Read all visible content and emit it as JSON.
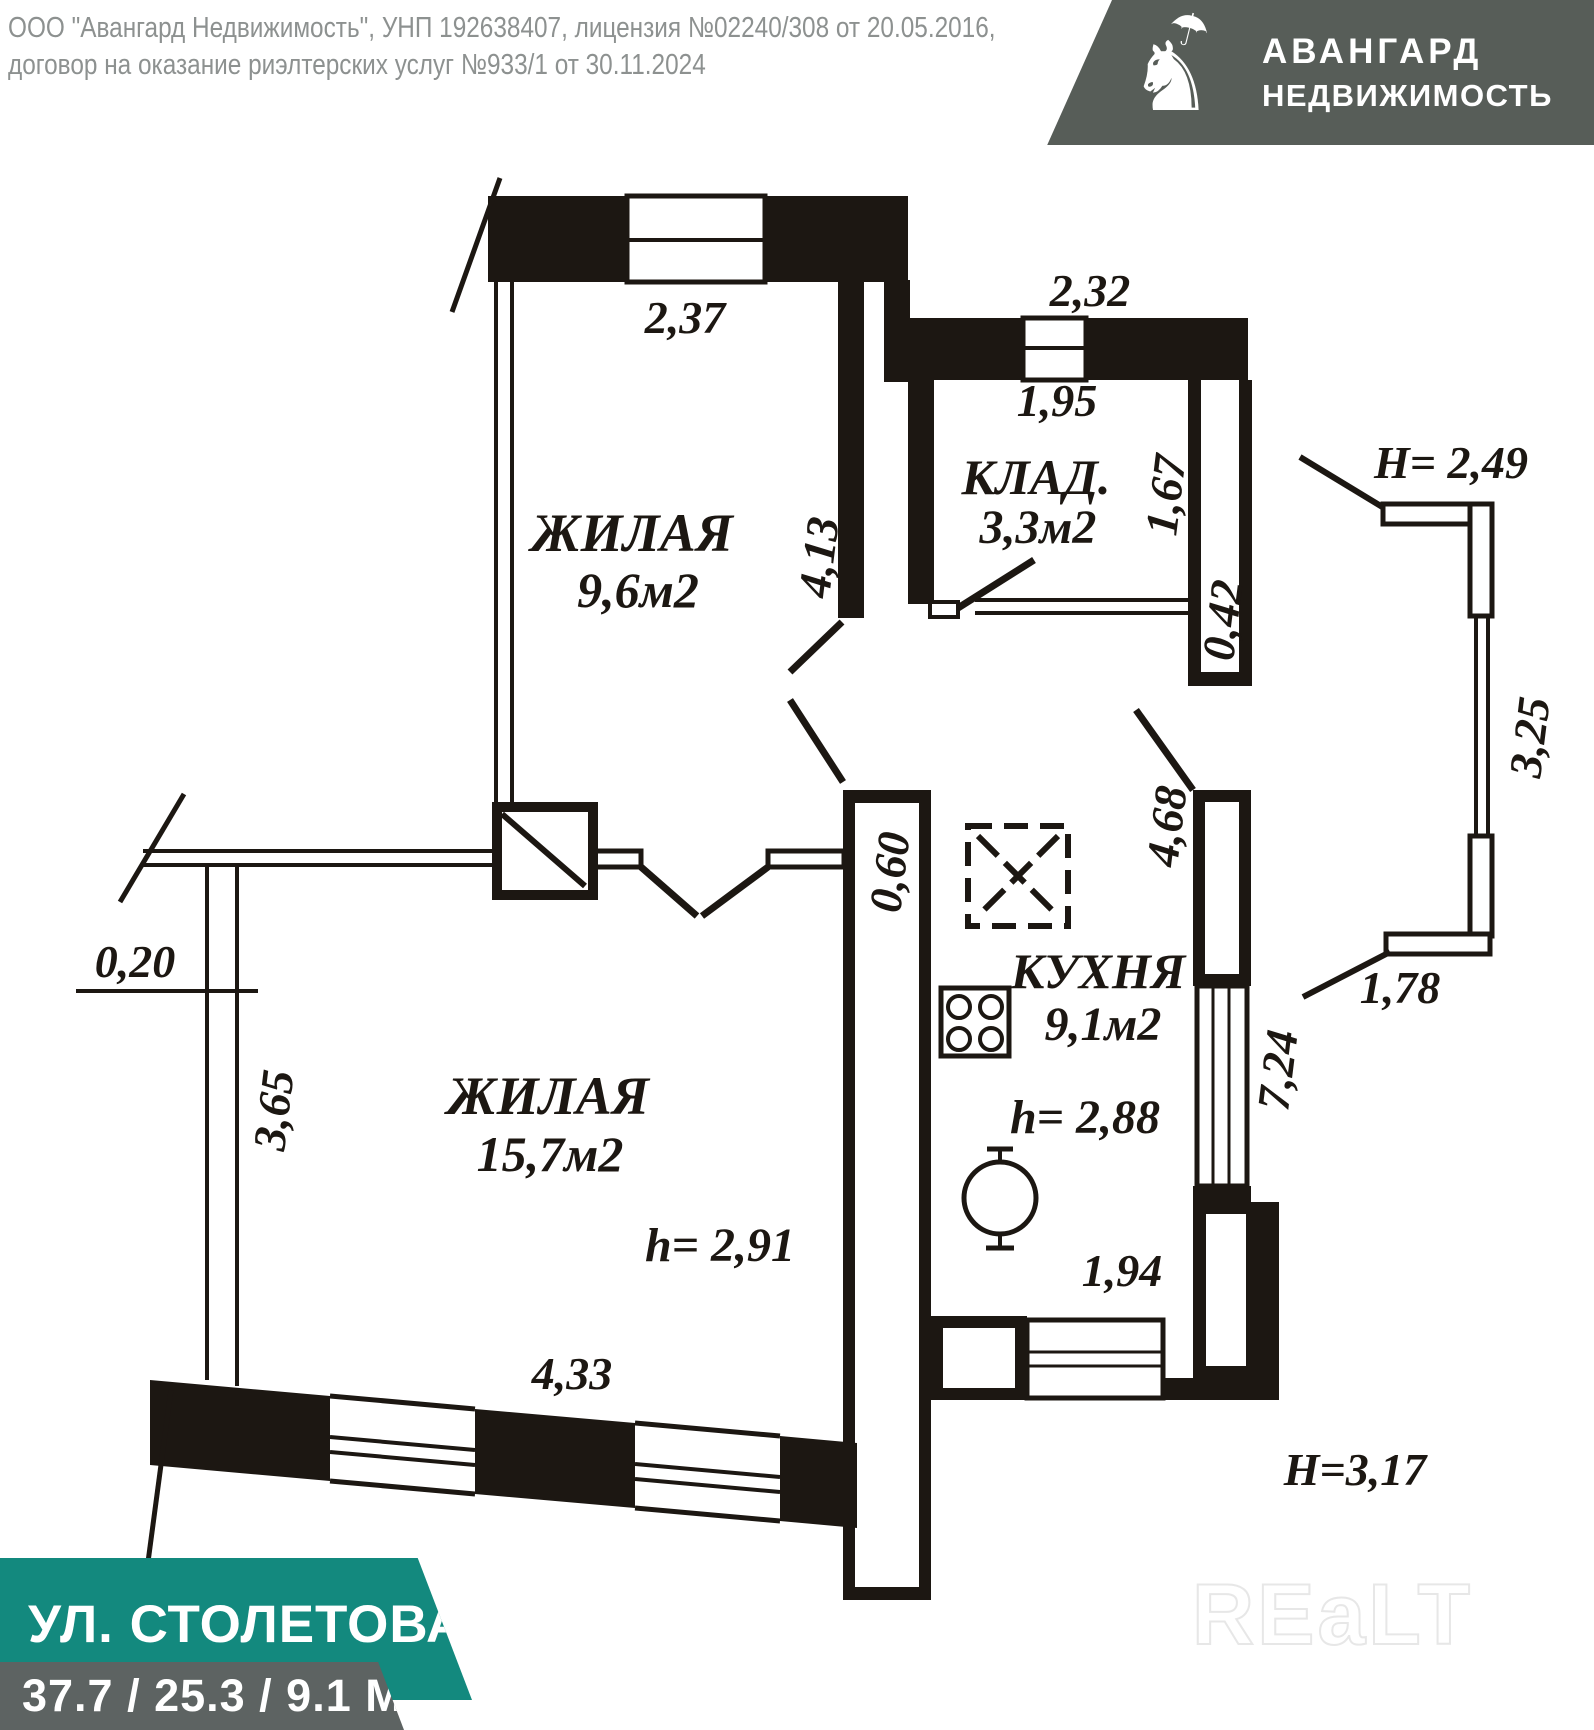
{
  "header": {
    "line1": "ООО \"Авангард Недвижимость\", УНП 192638407, лицензия №02240/308 от 20.05.2016,",
    "line2": "договор на оказание риэлтерских услуг №933/1 от 30.11.2024"
  },
  "logo": {
    "line1": "АВАНГАРД",
    "line2": "НЕДВИЖИМОСТЬ",
    "bg_color": "#575d58",
    "knight_icon": "knight-on-horse-with-umbrella",
    "horse_glyph": "♞",
    "umbrella_glyph": "☂"
  },
  "plan": {
    "ink_color": "#1c1712",
    "room_living1": {
      "name": "ЖИЛАЯ",
      "area": "9,6м2"
    },
    "room_storage": {
      "name": "КЛАД.",
      "area": "3,3м2"
    },
    "room_living2": {
      "name": "ЖИЛАЯ",
      "area": "15,7м2",
      "ceiling": "h= 2,91"
    },
    "room_kitchen": {
      "name": "КУХНЯ",
      "area": "9,1м2",
      "ceiling": "h= 2,88"
    },
    "dims": {
      "d237": "2,37",
      "d232": "2,32",
      "d195": "1,95",
      "d167": "1,67",
      "d042": "0,42",
      "h249": "H= 2,49",
      "d325": "3,25",
      "d178": "1,78",
      "d413": "4,13",
      "d060": "0,60",
      "d468": "4,68",
      "d724": "7,24",
      "d194": "1,94",
      "d020": "0,20",
      "d365": "3,65",
      "d433": "4,33",
      "h317": "H=3,17"
    }
  },
  "footer": {
    "address": "УЛ. СТОЛЕТОВА, 6",
    "areas": "37.7 / 25.3 / 9.1 М2",
    "accent_color": "#13897e",
    "gray_color": "#5d6362"
  },
  "watermark": {
    "text": "REaLT"
  }
}
